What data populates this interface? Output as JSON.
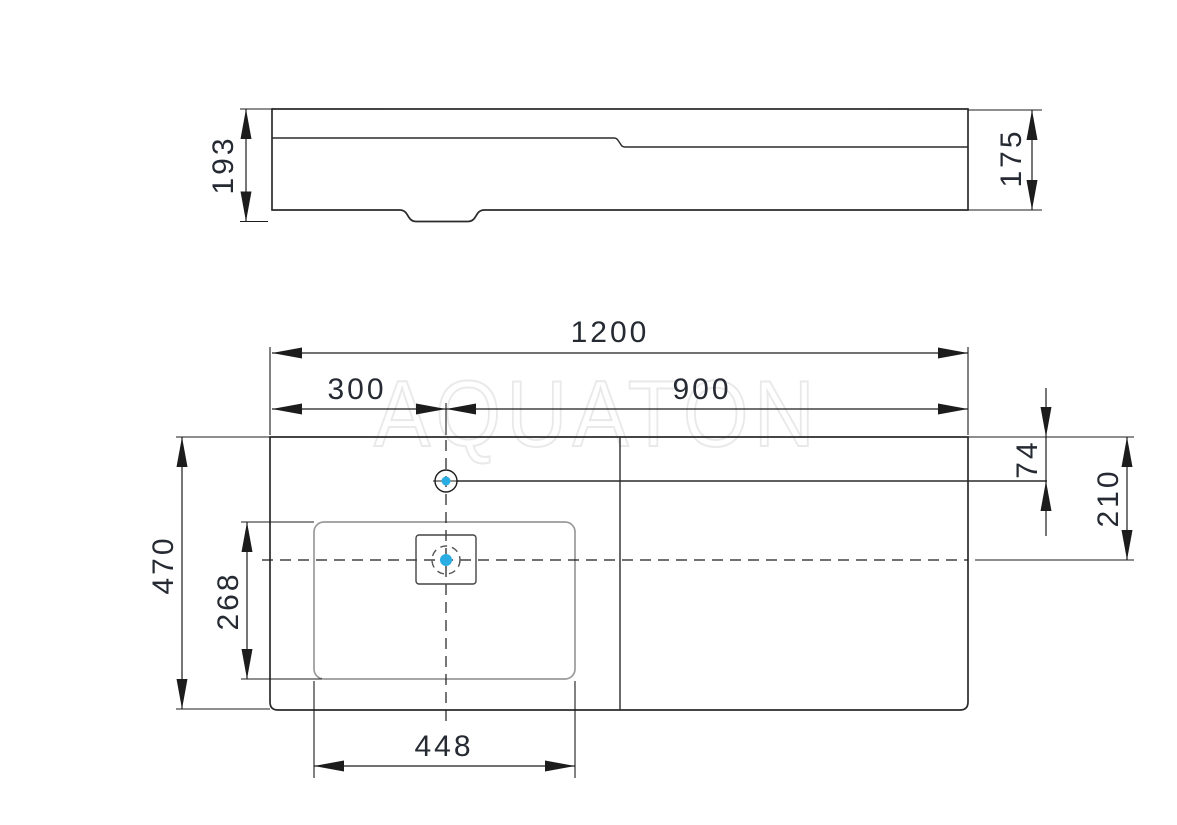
{
  "drawing": {
    "watermark": "AQUATON",
    "side_view": {
      "overall_height": "193",
      "right_section_height": "175"
    },
    "plan_view": {
      "overall_width": "1200",
      "basin_center_from_left": "300",
      "basin_center_to_right_edge": "900",
      "overall_depth": "470",
      "basin_depth": "268",
      "basin_width": "448",
      "faucet_hole_from_back_edge": "74",
      "basin_center_from_back_edge": "210"
    },
    "colors": {
      "accent": "#29ade3",
      "line": "#2b2b2b",
      "dim_text": "#262b33",
      "basin_line": "#9a9a9a",
      "watermark": "#e9e9e9"
    }
  }
}
